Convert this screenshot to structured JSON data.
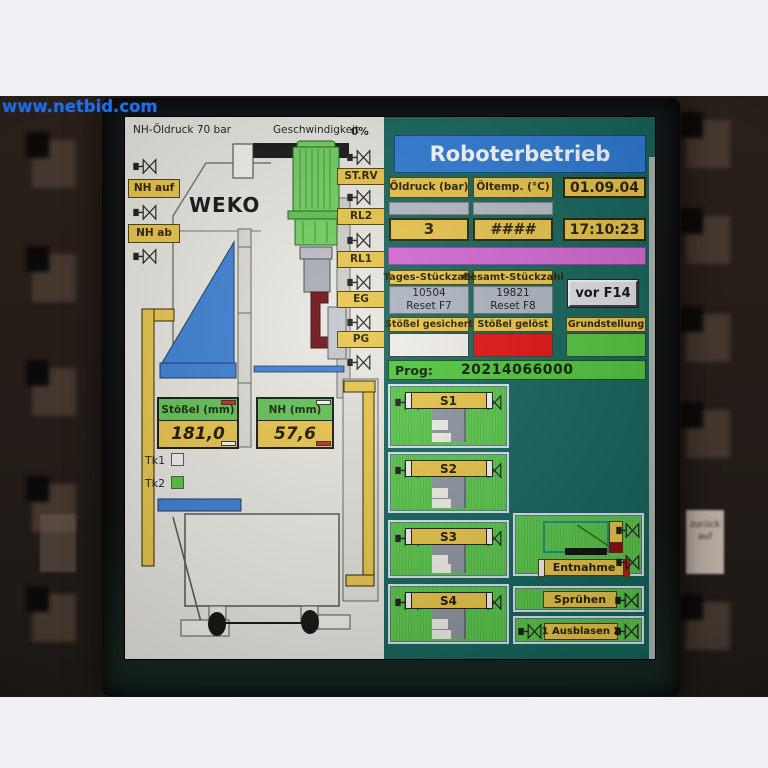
{
  "watermark": "www.netbid.com",
  "background": {
    "key_sticker_text": "zurück auf"
  },
  "colors": {
    "accent_yellow": "#eac64b",
    "header_blue": "#2e7cd6",
    "panel_teal": "#15655c",
    "magenta_bar": "#d569d5",
    "status_red": "#e41212",
    "status_green": "#52c83e",
    "machine_green": "#6fcf5f",
    "ram_blue": "#3b7fd4"
  },
  "screen": {
    "diagram": {
      "pressure_note": "NH-Öldruck 70 bar",
      "speed_label": "Geschwindigkeit",
      "speed_value": "0%",
      "brand": "WEKO",
      "left_valves": [
        {
          "label": "NH auf"
        },
        {
          "label": "NH ab"
        }
      ],
      "valve_tags": [
        {
          "label": "ST.RV"
        },
        {
          "label": "RL2"
        },
        {
          "label": "RL1"
        },
        {
          "label": "EG"
        },
        {
          "label": "PG"
        }
      ],
      "gauges": [
        {
          "label": "Stößel (mm)",
          "value": "181,0"
        },
        {
          "label": "NH (mm)",
          "value": "57,6"
        }
      ],
      "tools": [
        {
          "label": "Tk1"
        },
        {
          "label": "Tk2"
        }
      ]
    },
    "panel": {
      "title": "Roboterbetrieb",
      "oil_pressure": {
        "label": "Öldruck (bar)",
        "value": "3"
      },
      "oil_temp": {
        "label": "Öltemp. (°C)",
        "value": "####"
      },
      "date": "01.09.04",
      "time": "17:10:23",
      "day_counter": {
        "label": "Tages-Stückzahl",
        "value": "10504",
        "reset": "Reset F7"
      },
      "total_counter": {
        "label": "Gesamt-Stückzahl",
        "value": "19821",
        "reset": "Reset F8"
      },
      "vor_button": "vor F14",
      "status": [
        {
          "label": "Stößel gesichert",
          "state_color": "#f2f1ec"
        },
        {
          "label": "Stößel gelöst",
          "state_color": "#e41212"
        },
        {
          "label": "Grundstellung",
          "state_color": "#52c83e"
        }
      ],
      "prog": {
        "label": "Prog:",
        "value": "20214066000"
      },
      "stations": [
        {
          "label": "S1"
        },
        {
          "label": "S2"
        },
        {
          "label": "S3"
        },
        {
          "label": "S4"
        }
      ],
      "entnahme_label": "Entnahme",
      "spruehen_label": "Sprühen",
      "ausblasen_label": "1 Ausblasen 2"
    }
  }
}
